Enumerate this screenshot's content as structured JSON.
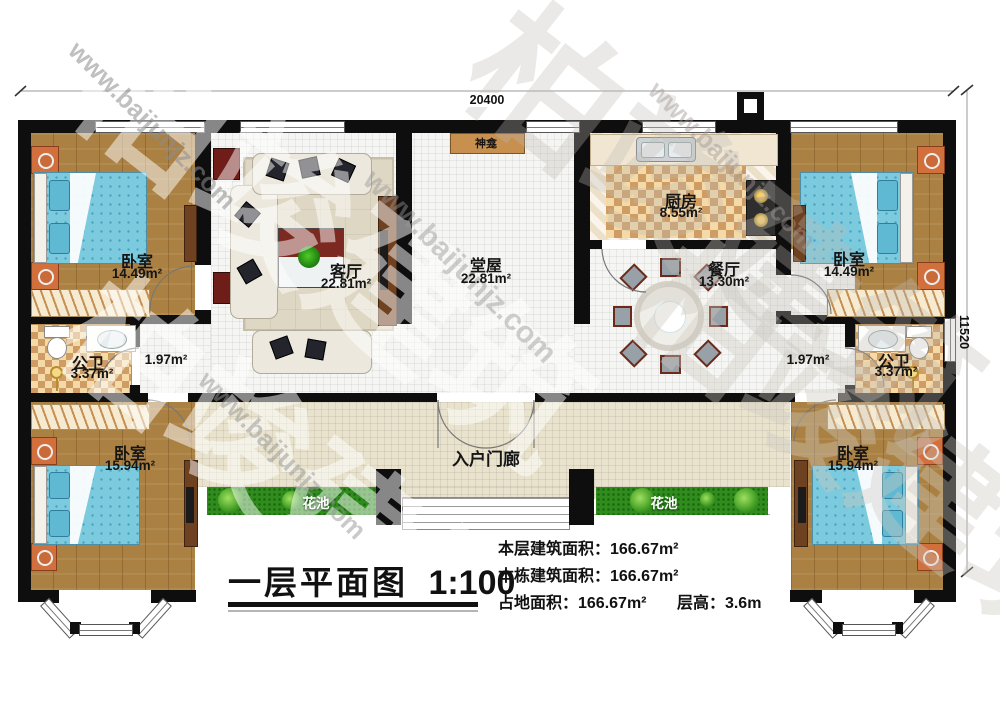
{
  "title": {
    "name": "一层平面图",
    "scale": "1:100"
  },
  "stats": {
    "line1": "本层建筑面积：166.67m²",
    "line2": "本栋建筑面积：166.67m²",
    "line3a": "占地面积：166.67m²",
    "line3b": "层高：3.6m"
  },
  "dimensions": {
    "top": "20400",
    "right": "11520"
  },
  "watermark": {
    "brand": "柏竣建筑",
    "url": "www.baijunjz.com"
  },
  "rooms": {
    "bedroom_tl": {
      "name": "卧室",
      "area": "14.49m²"
    },
    "living": {
      "name": "客厅",
      "area": "22.81m²"
    },
    "hall": {
      "name": "堂屋",
      "area": "22.81m²"
    },
    "shrine": {
      "name": "神龛"
    },
    "kitchen": {
      "name": "厨房",
      "area": "8.55m²"
    },
    "dining": {
      "name": "餐厅",
      "area": "13.30m²"
    },
    "bedroom_tr": {
      "name": "卧室",
      "area": "14.49m²"
    },
    "bath_l": {
      "name": "公卫",
      "area": "3.37m²"
    },
    "corridor_l": {
      "area": "1.97m²"
    },
    "bath_r": {
      "name": "公卫",
      "area": "3.37m²"
    },
    "corridor_r": {
      "area": "1.97m²"
    },
    "bedroom_bl": {
      "name": "卧室",
      "area": "15.94m²"
    },
    "bedroom_br": {
      "name": "卧室",
      "area": "15.94m²"
    },
    "porch": {
      "name": "入户门廊"
    },
    "flower_l": {
      "name": "花池"
    },
    "flower_r": {
      "name": "花池"
    }
  },
  "colors": {
    "wall": "#0e0e0e",
    "wood_floor": "#ab8143",
    "tile_floor": "#f5f5f3",
    "kitchen_check": "#cf9d63",
    "bed_blue": "#7ccade",
    "flower_green": "#2f8c1d",
    "cabinet_red": "#6e1d18",
    "porch_tile": "#e9e3cd"
  }
}
